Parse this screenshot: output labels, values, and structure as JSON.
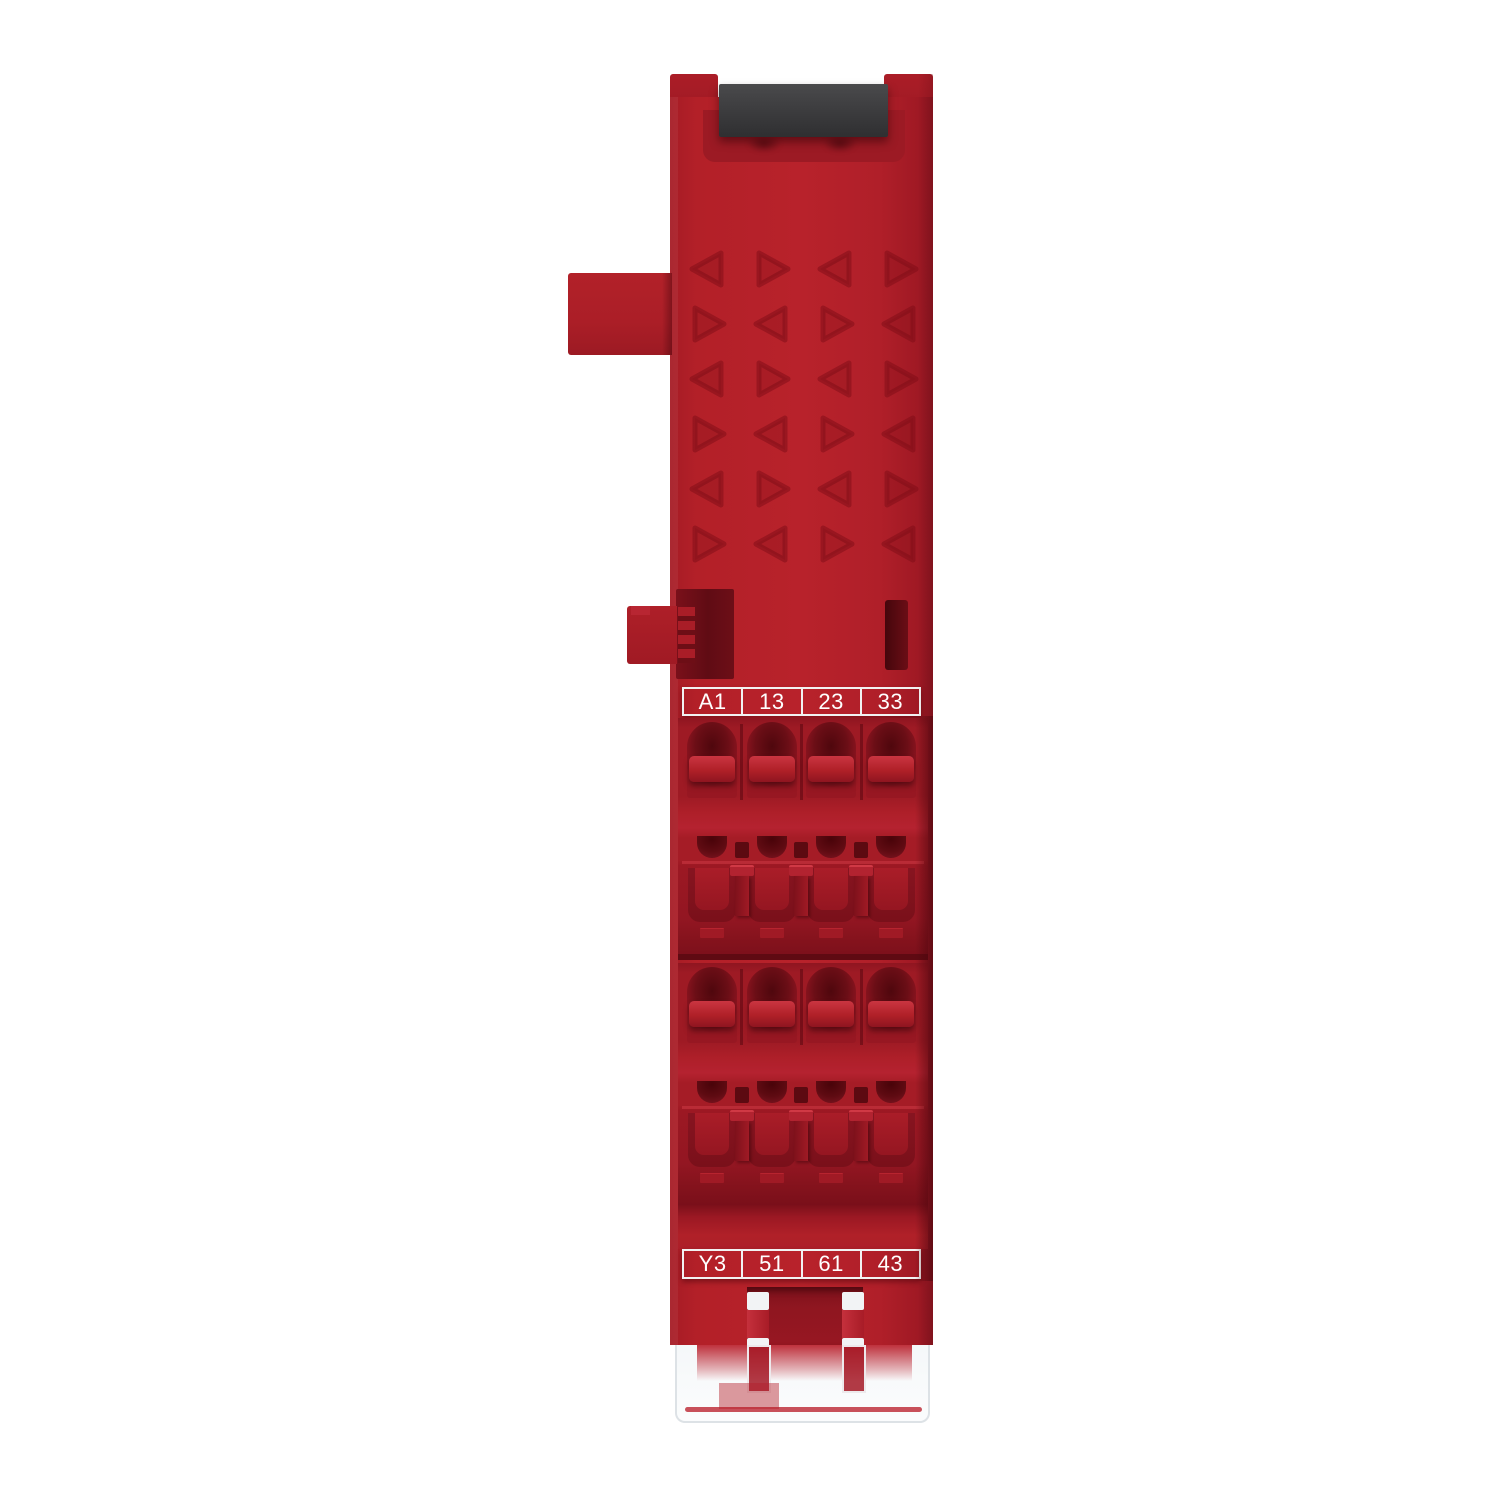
{
  "product": {
    "name": "safety-relay-module",
    "description": "Front view product photo of a red DIN-rail mounted safety relay module with two 4-pole spring terminal blocks, black DIN clip on top and transparent base at bottom",
    "body_color": "#b5202b",
    "body_shadow_color": "#8c1520",
    "terminal_hole_color": "#5e0b12",
    "din_clip_color": "#3b3b3d",
    "label_text_color": "#ffffff",
    "label_border_color": "#f2f2f2",
    "clear_plastic_color": "#eef1f3",
    "background_color": "#ffffff"
  },
  "terminal_labels": {
    "top": [
      "A1",
      "13",
      "23",
      "33"
    ],
    "bottom": [
      "Y3",
      "51",
      "61",
      "43"
    ]
  }
}
